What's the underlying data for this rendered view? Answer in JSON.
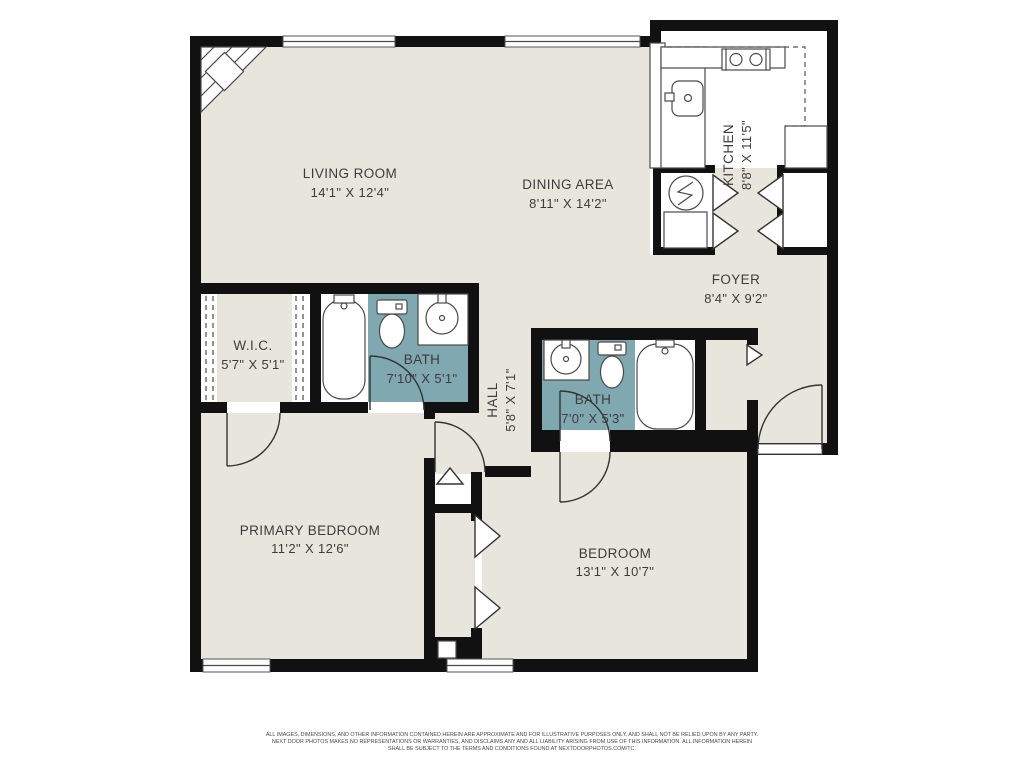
{
  "plan": {
    "title": "Two bedroom apartment floor plan",
    "rooms": [
      {
        "id": "living_room",
        "label": "LIVING ROOM",
        "dims": "14'1\" X 12'4\""
      },
      {
        "id": "dining_area",
        "label": "DINING AREA",
        "dims": "8'11\" X 14'2\""
      },
      {
        "id": "kitchen",
        "label": "KITCHEN",
        "dims": "8'8\" X 11'5\""
      },
      {
        "id": "foyer",
        "label": "FOYER",
        "dims": "8'4\" X 9'2\""
      },
      {
        "id": "wic",
        "label": "W.I.C.",
        "dims": "5'7\" X 5'1\""
      },
      {
        "id": "bath1",
        "label": "BATH",
        "dims": "7'10\" X 5'1\""
      },
      {
        "id": "hall",
        "label": "HALL",
        "dims": "5'8\" X 7'1\""
      },
      {
        "id": "bath2",
        "label": "BATH",
        "dims": "7'0\" X 5'3\""
      },
      {
        "id": "primary_bedroom",
        "label": "PRIMARY BEDROOM",
        "dims": "11'2\" X 12'6\""
      },
      {
        "id": "bedroom",
        "label": "BEDROOM",
        "dims": "13'1\" X 10'7\""
      }
    ],
    "colors": {
      "floor": "#E8E6DC",
      "bath_floor": "#7FA8B0",
      "wall": "#111111",
      "text": "#3C3C3C",
      "background": "#FFFFFF"
    },
    "icons": [
      "bathtub-icon",
      "toilet-icon",
      "sink-icon",
      "stove-icon",
      "kitchen-sink-icon",
      "water-heater-icon",
      "fireplace-icon",
      "window",
      "door-arc",
      "bifold-door"
    ],
    "disclaimer": [
      "ALL IMAGES, DIMENSIONS, AND OTHER INFORMATION CONTAINED HEREIN ARE APPROXIMATE AND FOR ILLUSTRATIVE PURPOSES ONLY, AND SHALL NOT BE RELIED UPON BY ANY PARTY.",
      "NEXT DOOR PHOTOS MAKES NO REPRESENTATIONS OR WARRANTIES, AND DISCLAIMS ANY AND ALL LIABILITY ARISING FROM USE OF THIS INFORMATION. ALL INFORMATION HEREIN",
      "SHALL BE SUBJECT TO THE TERMS AND CONDITIONS FOUND AT NEXTDOORPHOTOS.COM/TC."
    ]
  }
}
